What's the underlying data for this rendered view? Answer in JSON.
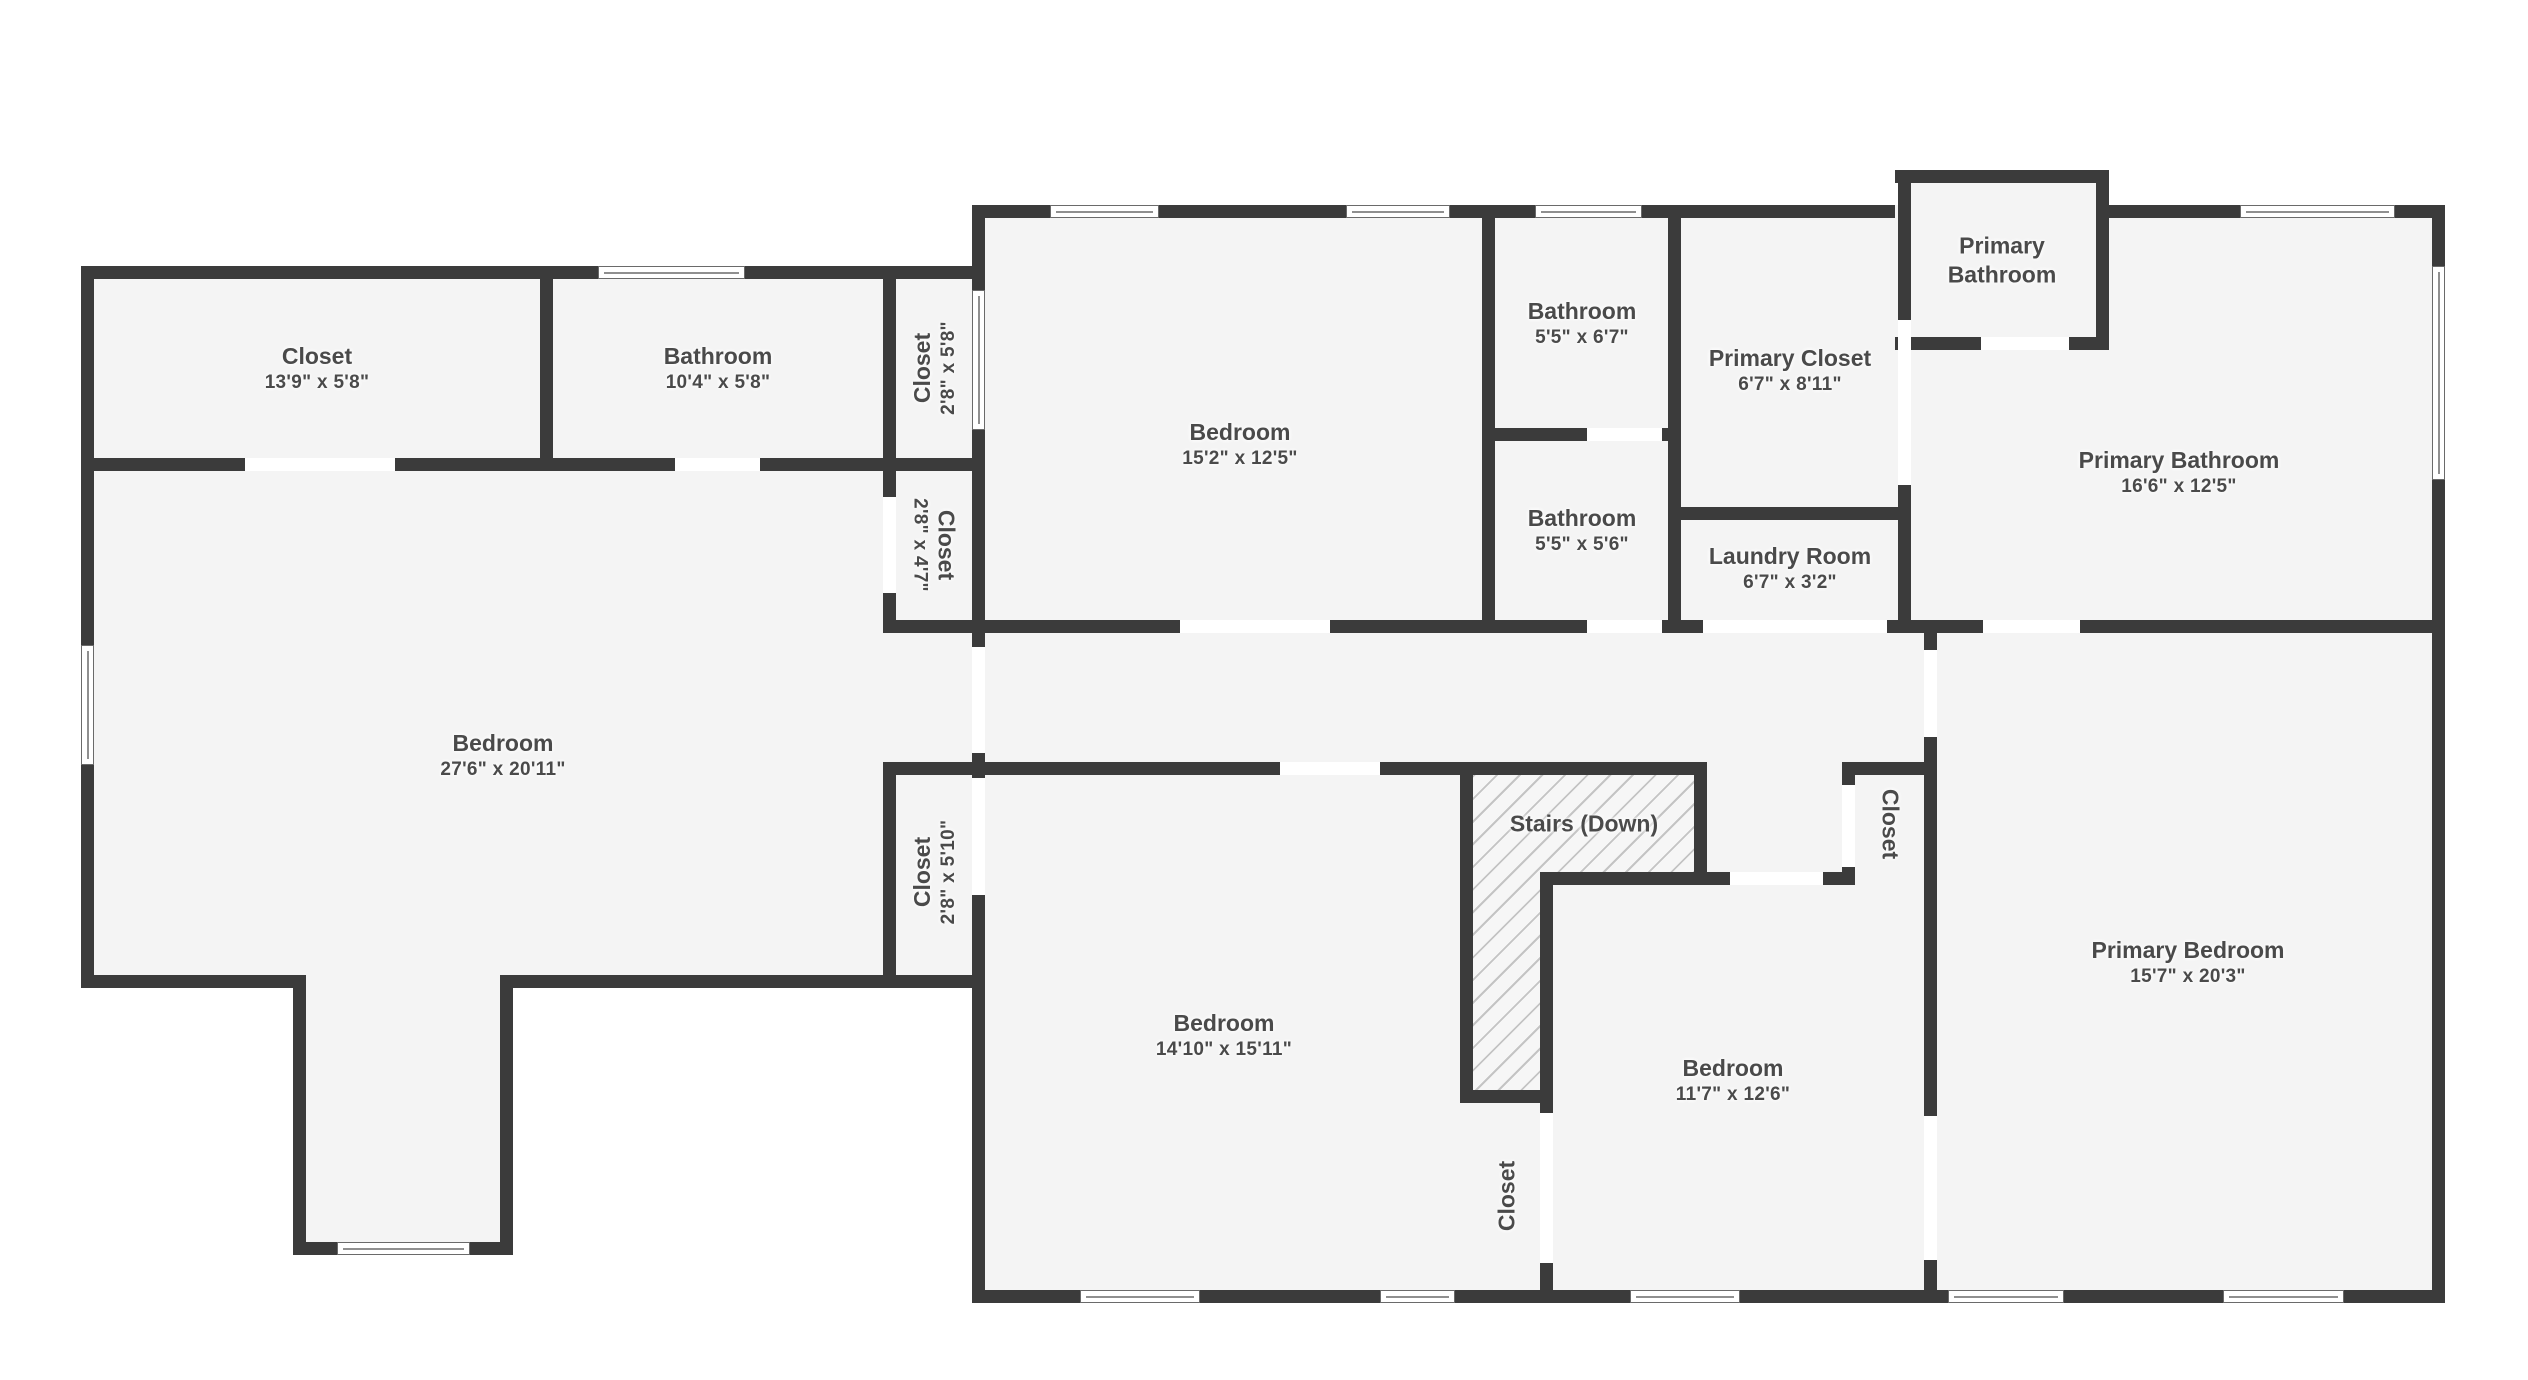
{
  "plan": {
    "title": "Second floor plan",
    "colors": {
      "background": "#ffffff",
      "floor": "#f4f4f4",
      "wall": "#3b3b3b",
      "door_opening": "#ffffff",
      "window": "#ffffff",
      "label": "#4a4a4a",
      "stairs_hatch_line": "#c4c4c4"
    },
    "rooms": [
      {
        "name": "Closet",
        "dims": "13'9\" x 5'8\"",
        "x": 317,
        "y": 368,
        "rotate": 0
      },
      {
        "name": "Bathroom",
        "dims": "10'4\" x 5'8\"",
        "x": 718,
        "y": 368,
        "rotate": 0
      },
      {
        "name": "Closet",
        "dims": "2'8\" x 5'8\"",
        "x": 934,
        "y": 368,
        "rotate": -90
      },
      {
        "name": "Bedroom",
        "dims": "15'2\" x 12'5\"",
        "x": 1240,
        "y": 444,
        "rotate": 0
      },
      {
        "name": "Bathroom",
        "dims": "5'5\" x 6'7\"",
        "x": 1582,
        "y": 323,
        "rotate": 0
      },
      {
        "name": "Primary Closet",
        "dims": "6'7\" x 8'11\"",
        "x": 1790,
        "y": 370,
        "rotate": 0
      },
      {
        "name": "Primary\nBathroom",
        "dims": "",
        "x": 2002,
        "y": 260,
        "rotate": 0
      },
      {
        "name": "Primary Bathroom",
        "dims": "16'6\" x 12'5\"",
        "x": 2179,
        "y": 472,
        "rotate": 0
      },
      {
        "name": "Bathroom",
        "dims": "5'5\" x 5'6\"",
        "x": 1582,
        "y": 530,
        "rotate": 0
      },
      {
        "name": "Laundry Room",
        "dims": "6'7\" x 3'2\"",
        "x": 1790,
        "y": 568,
        "rotate": 0
      },
      {
        "name": "Closet",
        "dims": "2'8\" x 4'7\"",
        "x": 934,
        "y": 545,
        "rotate": 90
      },
      {
        "name": "Bedroom",
        "dims": "27'6\" x 20'11\"",
        "x": 503,
        "y": 755,
        "rotate": 0
      },
      {
        "name": "Closet",
        "dims": "2'8\" x 5'10\"",
        "x": 934,
        "y": 872,
        "rotate": -90
      },
      {
        "name": "Stairs (Down)",
        "dims": "",
        "x": 1584,
        "y": 824,
        "rotate": 0
      },
      {
        "name": "Closet",
        "dims": "",
        "x": 1890,
        "y": 824,
        "rotate": 90
      },
      {
        "name": "Bedroom",
        "dims": "14'10\" x 15'11\"",
        "x": 1224,
        "y": 1035,
        "rotate": 0
      },
      {
        "name": "Bedroom",
        "dims": "11'7\" x 12'6\"",
        "x": 1733,
        "y": 1080,
        "rotate": 0
      },
      {
        "name": "Closet",
        "dims": "",
        "x": 1507,
        "y": 1196,
        "rotate": -90
      },
      {
        "name": "Primary Bedroom",
        "dims": "15'7\" x 20'3\"",
        "x": 2188,
        "y": 962,
        "rotate": 0
      }
    ],
    "floors": [
      [
        81,
        266,
        904,
        722
      ],
      [
        293,
        975,
        220,
        280
      ],
      [
        972,
        205,
        1473,
        1098
      ],
      [
        1908,
        170,
        188,
        70
      ]
    ],
    "hatch": [
      [
        1473,
        775,
        221,
        97
      ],
      [
        1473,
        775,
        67,
        315
      ]
    ],
    "walls": [
      [
        81,
        266,
        904,
        13
      ],
      [
        81,
        266,
        13,
        722
      ],
      [
        81,
        458,
        904,
        13
      ],
      [
        540,
        279,
        13,
        179
      ],
      [
        883,
        266,
        13,
        205
      ],
      [
        883,
        458,
        13,
        174
      ],
      [
        883,
        762,
        13,
        226
      ],
      [
        883,
        620,
        102,
        13
      ],
      [
        883,
        762,
        102,
        13
      ],
      [
        81,
        975,
        225,
        13
      ],
      [
        293,
        975,
        13,
        280
      ],
      [
        293,
        1242,
        220,
        13
      ],
      [
        500,
        975,
        13,
        280
      ],
      [
        500,
        975,
        485,
        13
      ],
      [
        972,
        205,
        13,
        1098
      ],
      [
        972,
        205,
        923,
        13
      ],
      [
        2109,
        205,
        336,
        13
      ],
      [
        2432,
        205,
        13,
        1098
      ],
      [
        972,
        1290,
        1473,
        13
      ],
      [
        1482,
        218,
        13,
        415
      ],
      [
        1482,
        428,
        199,
        13
      ],
      [
        1668,
        218,
        13,
        415
      ],
      [
        1668,
        507,
        243,
        13
      ],
      [
        1898,
        183,
        13,
        450
      ],
      [
        1895,
        170,
        214,
        13
      ],
      [
        2096,
        170,
        13,
        180
      ],
      [
        1895,
        337,
        214,
        13
      ],
      [
        972,
        620,
        1473,
        13
      ],
      [
        1924,
        633,
        13,
        670
      ],
      [
        972,
        762,
        735,
        13
      ],
      [
        1842,
        762,
        95,
        13
      ],
      [
        1842,
        762,
        13,
        123
      ],
      [
        1540,
        872,
        315,
        13
      ],
      [
        1540,
        872,
        13,
        431
      ],
      [
        1460,
        775,
        13,
        328
      ],
      [
        1694,
        775,
        13,
        110
      ],
      [
        1460,
        1090,
        93,
        13
      ]
    ],
    "doors": [
      [
        245,
        458,
        150,
        13
      ],
      [
        675,
        458,
        85,
        13
      ],
      [
        883,
        497,
        13,
        96
      ],
      [
        972,
        647,
        13,
        106
      ],
      [
        972,
        778,
        13,
        117
      ],
      [
        1587,
        428,
        75,
        13
      ],
      [
        1898,
        320,
        13,
        165
      ],
      [
        1981,
        337,
        88,
        13
      ],
      [
        1180,
        620,
        150,
        13
      ],
      [
        1587,
        620,
        75,
        13
      ],
      [
        1703,
        620,
        184,
        13
      ],
      [
        1983,
        620,
        97,
        13
      ],
      [
        1924,
        650,
        13,
        87
      ],
      [
        1924,
        1116,
        13,
        144
      ],
      [
        1280,
        762,
        100,
        13
      ],
      [
        1842,
        785,
        13,
        82
      ],
      [
        1730,
        872,
        93,
        13
      ],
      [
        1540,
        1113,
        13,
        150
      ]
    ],
    "windows": [
      [
        598,
        266,
        147,
        13,
        "h"
      ],
      [
        81,
        645,
        13,
        120,
        "v"
      ],
      [
        337,
        1242,
        133,
        13,
        "h"
      ],
      [
        972,
        290,
        13,
        140,
        "v"
      ],
      [
        1050,
        205,
        109,
        13,
        "h"
      ],
      [
        1346,
        205,
        104,
        13,
        "h"
      ],
      [
        1535,
        205,
        107,
        13,
        "h"
      ],
      [
        2240,
        205,
        155,
        13,
        "h"
      ],
      [
        2432,
        266,
        13,
        214,
        "v"
      ],
      [
        1080,
        1290,
        120,
        13,
        "h"
      ],
      [
        1380,
        1290,
        75,
        13,
        "h"
      ],
      [
        1630,
        1290,
        110,
        13,
        "h"
      ],
      [
        1948,
        1290,
        116,
        13,
        "h"
      ],
      [
        2223,
        1290,
        121,
        13,
        "h"
      ]
    ]
  }
}
